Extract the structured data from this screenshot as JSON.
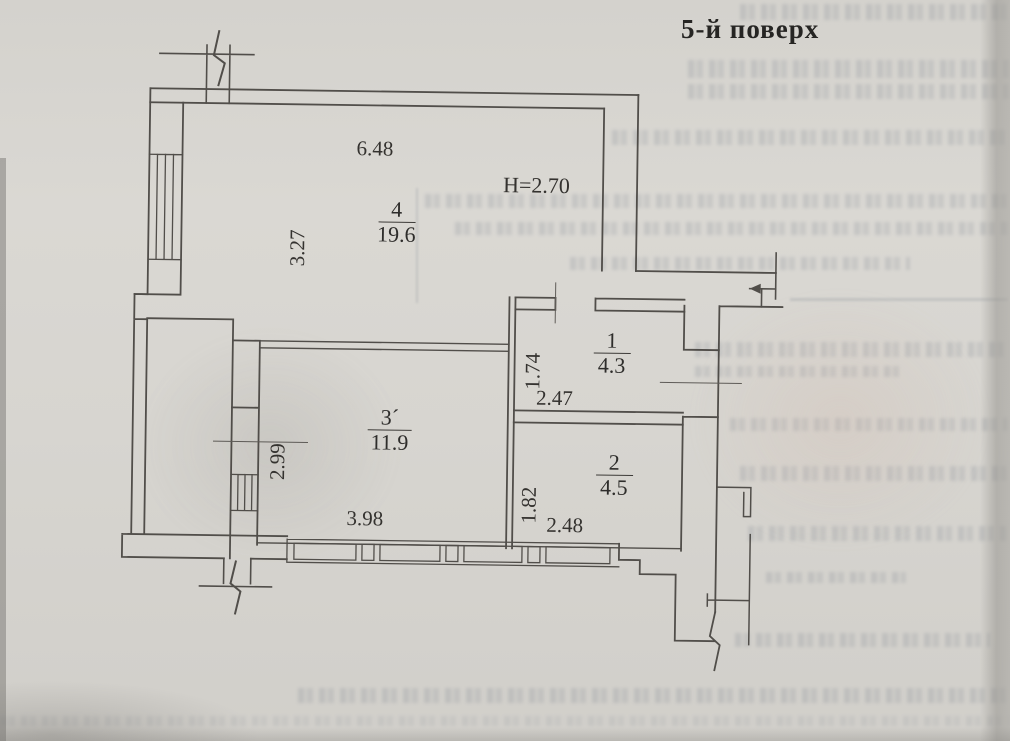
{
  "title": "5-й поверх",
  "plan": {
    "height_note": "H=2.70",
    "rooms": [
      {
        "id": "room-4",
        "number": "4",
        "area": "19.6",
        "width_label": "6.48",
        "height_label": "3.27"
      },
      {
        "id": "room-1",
        "number": "1",
        "area": "4.3",
        "width_label": "2.47",
        "height_label": "1.74"
      },
      {
        "id": "room-2",
        "number": "2",
        "area": "4.5",
        "width_label": "2.48",
        "height_label": "1.82"
      },
      {
        "id": "room-3",
        "number": "3´",
        "area": "11.9",
        "width_label": "3.98",
        "height_label": "2.99"
      }
    ]
  },
  "colors": {
    "paper": "#d7d5d0",
    "ink": "#46433f",
    "bleed": "#606a7a"
  }
}
